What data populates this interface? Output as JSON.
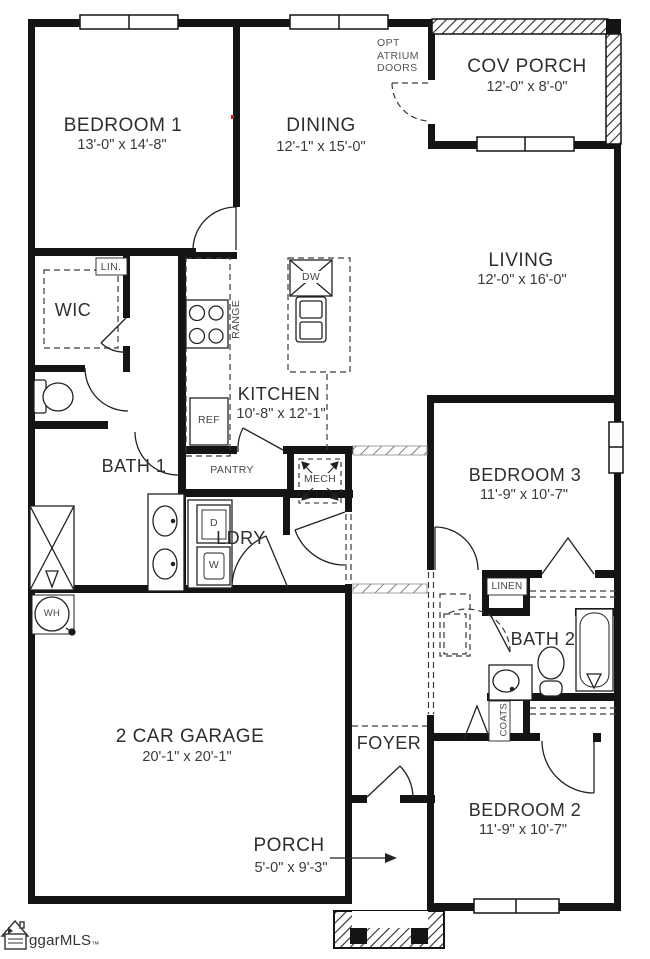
{
  "colors": {
    "wall": "#141414",
    "line": "#222222",
    "label": "#2e2e2e",
    "dim": "#3a3a3a",
    "small": "#474747",
    "marker_red": "#bb2222"
  },
  "rooms": [
    {
      "id": "bedroom1",
      "name": "BEDROOM 1",
      "dims": "13'-0\" x 14'-8\""
    },
    {
      "id": "dining",
      "name": "DINING",
      "dims": "12'-1\" x 15'-0\""
    },
    {
      "id": "cov_porch",
      "name": "COV PORCH",
      "dims": "12'-0\" x 8'-0\""
    },
    {
      "id": "living",
      "name": "LIVING",
      "dims": "12'-0\" x 16'-0\""
    },
    {
      "id": "wic",
      "name": "WIC",
      "dims": ""
    },
    {
      "id": "bath1",
      "name": "BATH 1",
      "dims": ""
    },
    {
      "id": "kitchen",
      "name": "KITCHEN",
      "dims": "10'-8\" x 12'-1\""
    },
    {
      "id": "ldry",
      "name": "LDRY",
      "dims": ""
    },
    {
      "id": "bedroom3",
      "name": "BEDROOM 3",
      "dims": "11'-9\" x 10'-7\""
    },
    {
      "id": "bath2",
      "name": "BATH 2",
      "dims": ""
    },
    {
      "id": "garage",
      "name": "2 CAR GARAGE",
      "dims": "20'-1\" x 20'-1\""
    },
    {
      "id": "foyer",
      "name": "FOYER",
      "dims": ""
    },
    {
      "id": "porch",
      "name": "PORCH",
      "dims": "5'-0\" x 9'-3\""
    },
    {
      "id": "bedroom2",
      "name": "BEDROOM 2",
      "dims": "11'-9\" x 10'-7\""
    }
  ],
  "labels": {
    "lin": "LIN.",
    "linen": "LINEN",
    "coats": "COATS",
    "pantry": "PANTRY",
    "mech": "MECH",
    "range": "RANGE",
    "ref": "REF",
    "dw": "DW",
    "dryer": "D",
    "washer": "W",
    "water_heater": "WH"
  },
  "annotations": {
    "opt_atrium_doors": [
      "OPT",
      "ATRIUM",
      "DOORS"
    ]
  },
  "branding": {
    "logo_text": "ggarMLS",
    "trademark": "™"
  }
}
